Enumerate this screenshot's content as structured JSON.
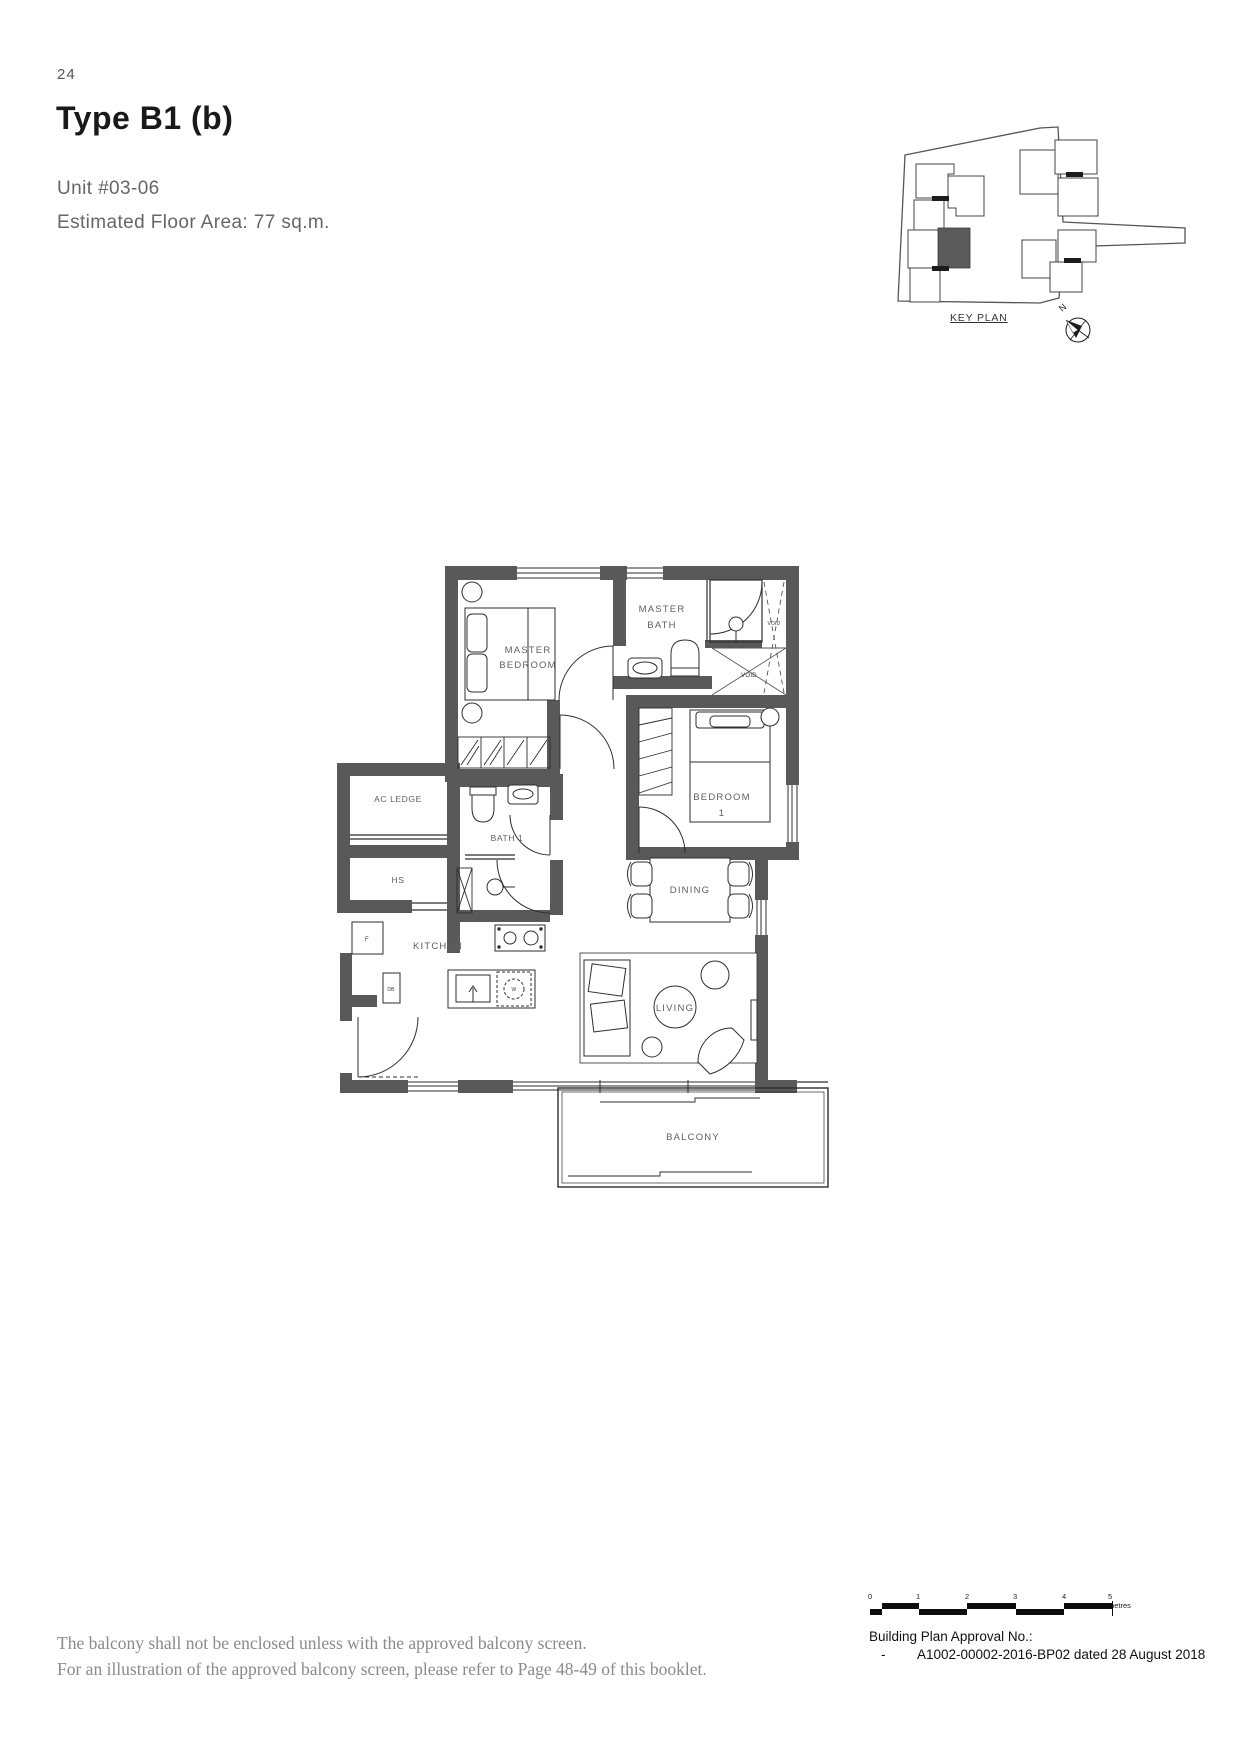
{
  "page_number": "24",
  "header": {
    "title": "Type B1 (b)",
    "unit": "Unit #03-06",
    "area": "Estimated Floor Area: 77 sq.m."
  },
  "key_plan": {
    "label": "KEY PLAN",
    "north": "N"
  },
  "plan": {
    "master_bedroom_l1": "MASTER",
    "master_bedroom_l2": "BEDROOM",
    "master_bath_l1": "MASTER",
    "master_bath_l2": "BATH",
    "void_strip": "VOID",
    "void_square": "VOID",
    "bedroom1_l1": "BEDROOM",
    "bedroom1_l2": "1",
    "ac_ledge": "AC LEDGE",
    "hs": "HS",
    "bath1": "BATH 1",
    "kitchen": "KITCHEN",
    "dining": "DINING",
    "living": "LIVING",
    "balcony": "BALCONY",
    "db": "DB",
    "fridge": "F",
    "washer": "W"
  },
  "notes": {
    "line1": "The balcony shall not be enclosed unless with the approved balcony screen.",
    "line2": "For an illustration of the approved balcony screen, please refer to Page 48-49 of this booklet."
  },
  "approval": {
    "title": "Building Plan Approval No.:",
    "dash": "-",
    "number": "A1002-00002-2016-BP02 dated 28 August 2018"
  },
  "scale": {
    "t0": "0",
    "t1": "1",
    "t2": "2",
    "t3": "3",
    "t4": "4",
    "t5": "5 metres"
  },
  "colors": {
    "wall": "#595959",
    "line": "#2e2e2e",
    "label": "#5f5f5f",
    "highlight": "#5a5a5a"
  }
}
